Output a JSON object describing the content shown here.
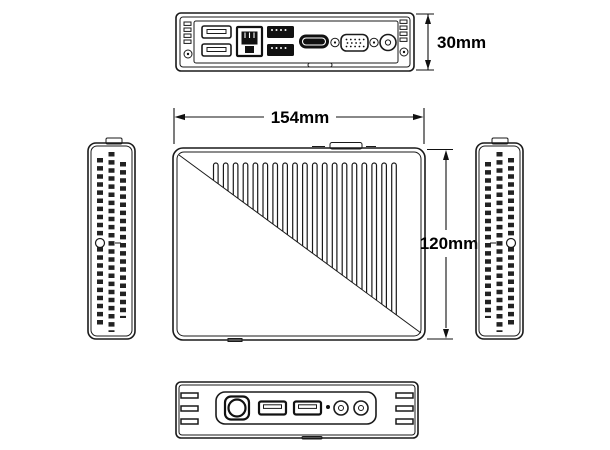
{
  "colors": {
    "line": "#1a1a1a",
    "background": "#ffffff",
    "label": "#000000"
  },
  "dimension_labels": {
    "width": "154mm",
    "height": "120mm",
    "depth": "30mm"
  },
  "views": {
    "rear_panel": {
      "ports": [
        "usb-a-dual",
        "ethernet-rj45",
        "usb-a-dual",
        "hdmi",
        "vga-dsub15",
        "dc-power-jack"
      ],
      "screw_count": 2,
      "vent_slats_per_side": 4
    },
    "main_face": {
      "fin_count": 19,
      "has_diagonal_split": true
    },
    "left_side": {
      "vent_columns": 3
    },
    "right_side": {
      "vent_columns": 3
    },
    "front_panel": {
      "ports": [
        "power-connector",
        "usb-a",
        "usb-a",
        "led-indicator",
        "audio-jack",
        "audio-jack"
      ],
      "vent_slats_per_side": 3
    }
  }
}
